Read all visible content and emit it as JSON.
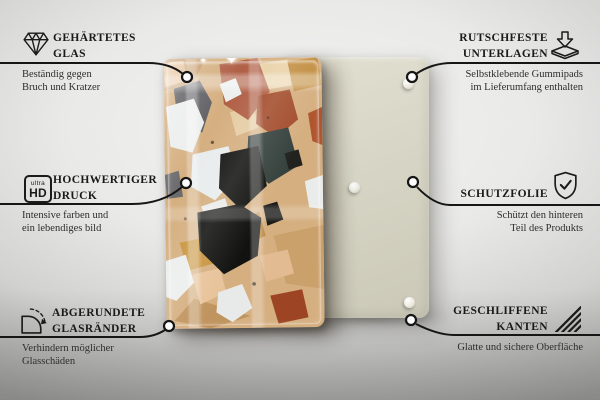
{
  "type": "product-feature-infographic",
  "language": "de",
  "callouts": {
    "left": [
      {
        "icon": "diamond-icon",
        "title_lines": [
          "GEHÄRTETES",
          "GLAS"
        ],
        "description_lines": [
          "Beständig gegen",
          "Bruch und Kratzer"
        ]
      },
      {
        "icon": "ultra-hd-icon",
        "icon_text": {
          "top": "ultra",
          "bottom": "HD"
        },
        "title_lines": [
          "HOCHWERTIGER",
          "DRUCK"
        ],
        "description_lines": [
          "Intensive farben und",
          "ein lebendiges bild"
        ]
      },
      {
        "icon": "rounded-corner-icon",
        "title_lines": [
          "ABGERUNDETE",
          "GLASRÄNDER"
        ],
        "description_lines": [
          "Verhindern möglicher",
          "Glasschäden"
        ]
      }
    ],
    "right": [
      {
        "icon": "rubber-pad-icon",
        "title_lines": [
          "RUTSCHFESTE",
          "UNTERLAGEN"
        ],
        "description_lines": [
          "Selbstklebende Gummipads",
          "im Lieferumfang enthalten"
        ]
      },
      {
        "icon": "shield-check-icon",
        "title_lines": [
          "SCHUTZFOLIE"
        ],
        "description_lines": [
          "Schützt den hinteren",
          "Teil des Produkts"
        ]
      },
      {
        "icon": "hatched-edges-icon",
        "title_lines": [
          "GESCHLIFFENE",
          "KANTEN"
        ],
        "description_lines": [
          "Glatte und sichere Oberfläche"
        ]
      }
    ]
  },
  "product_image": {
    "front_panel": "glass panel printed with terrazzo pattern",
    "back_panel": "beige rear panel with self-adhesive rubber pads",
    "visible_rubber_pads": 3,
    "sparkles": "✦"
  },
  "colors": {
    "line": "#161616",
    "title_text": "#1a1a1a",
    "description_text": "#2e2e2e",
    "back_panel": "#d6d4c4",
    "terrazzo_base": "#d5af80",
    "terracotta": "#b06046",
    "rust": "#9c4424",
    "dark_teal": "#36423e",
    "black_fragment": "#141413",
    "white_fragment": "#eceeed",
    "ochre": "#c28d3f"
  }
}
